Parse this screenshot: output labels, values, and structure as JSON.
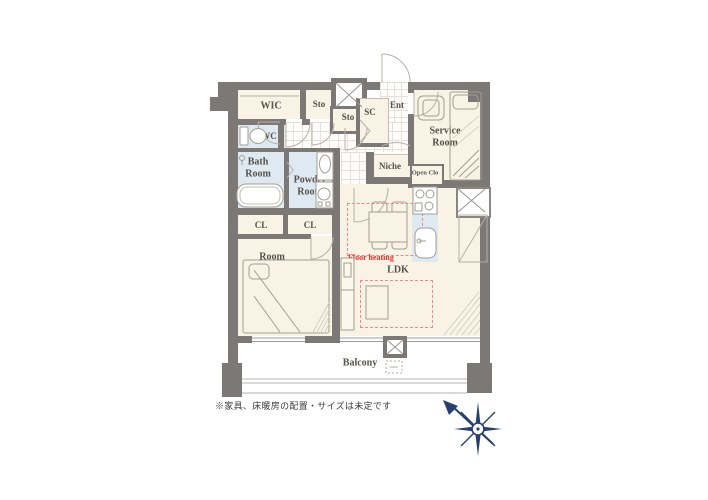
{
  "floor_plan": {
    "labels": {
      "wic": "WIC",
      "sto_upper": "Sto",
      "sto_lower": "Sto",
      "shoe_closet": "SC",
      "entrance": "Ent",
      "wc": "WC",
      "bath_room": "Bath Room",
      "powder_room": "Powder Room",
      "niche": "Niche",
      "service_room": "Service Room",
      "open_closet": "Open Clo",
      "closet_left": "CL",
      "closet_right": "CL",
      "bedroom": "Room",
      "living": "LDK",
      "floor_heating": "Floor heating",
      "balcony": "Balcony"
    },
    "note": "※家具、床暖房の配置・サイズは未定です",
    "colors": {
      "wall": "#7b7876",
      "room_floor": "#f8f3e4",
      "wet_area": "#dfe9f2",
      "floor_heating_red": "#e03030",
      "dashed_red": "#ef8a8a",
      "compass_navy": "#27406f"
    }
  }
}
